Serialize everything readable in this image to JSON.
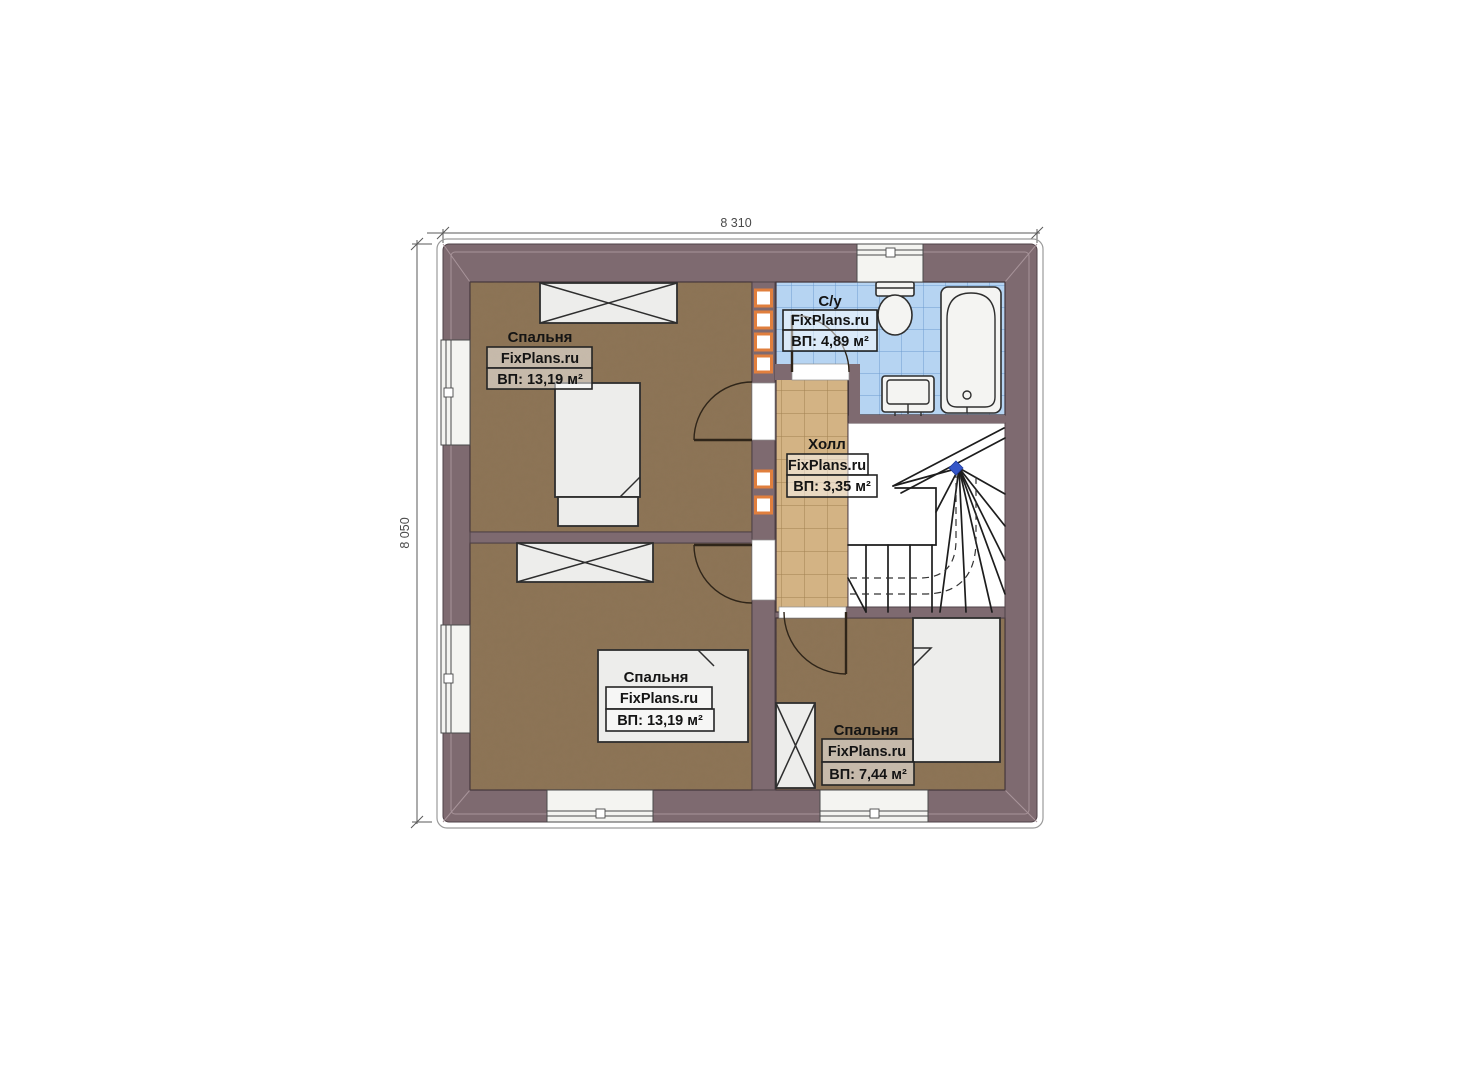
{
  "dimensions": {
    "width_label": "8 310",
    "height_label": "8 050"
  },
  "rooms": [
    {
      "key": "bedroom-top-left",
      "name": "Спальня",
      "brand": "FixPlans.ru",
      "area": "ВП: 13,19 м²"
    },
    {
      "key": "bathroom",
      "name": "С/у",
      "brand": "FixPlans.ru",
      "area": "ВП: 4,89 м²"
    },
    {
      "key": "hall",
      "name": "Холл",
      "brand": "FixPlans.ru",
      "area": "ВП: 3,35 м²"
    },
    {
      "key": "bedroom-bottom-left",
      "name": "Спальня",
      "brand": "FixPlans.ru",
      "area": "ВП: 13,19 м²"
    },
    {
      "key": "bedroom-bottom-right",
      "name": "Спальня",
      "brand": "FixPlans.ru",
      "area": "ВП: 7,44 м²"
    }
  ],
  "colors": {
    "wall": "#7e6a70",
    "wallLight": "#a8949a",
    "floor": "#8d7456",
    "floorEdge": "#44363b",
    "hall": "#d3b384",
    "hallGrid": "#a28050",
    "bath": "#b6d4f2",
    "bathGrid": "#6d9cd0",
    "furniture": "#ededeb",
    "furnitureStroke": "#2e2e2e",
    "vent": "#e07f3e"
  }
}
